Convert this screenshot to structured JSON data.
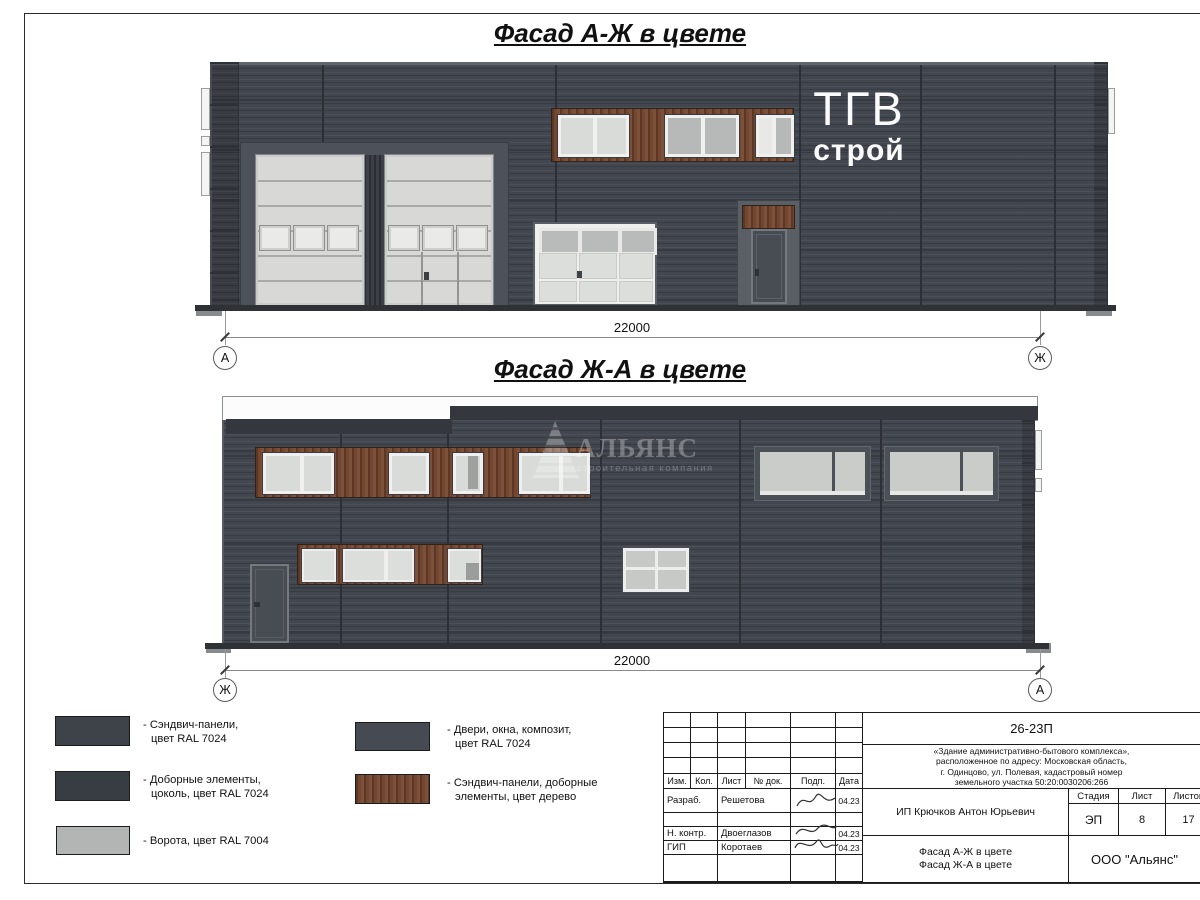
{
  "titles": {
    "facade1": "Фасад А-Ж в цвете",
    "facade2": "Фасад Ж-А в цвете"
  },
  "facade1": {
    "sign_line1": "ТГВ",
    "sign_line2": "строй",
    "dimension": "22000",
    "axis_left": "А",
    "axis_right": "Ж"
  },
  "facade2": {
    "dimension": "22000",
    "axis_left": "Ж",
    "axis_right": "А",
    "watermark_name": "АЛЬЯНС",
    "watermark_tagline": "строительная компания"
  },
  "legend": {
    "items": [
      {
        "line1": "- Сэндвич-панели,",
        "line2": "цвет RAL 7024",
        "color": "#3e434a"
      },
      {
        "line1": "- Доборные элементы,",
        "line2": "цоколь, цвет RAL 7024",
        "color": "#383c43"
      },
      {
        "line1": "- Ворота, цвет RAL 7004",
        "line2": "",
        "color": "#b3b5b4"
      },
      {
        "line1": "- Двери, окна, композит,",
        "line2": "цвет RAL 7024",
        "color": "#464b53"
      },
      {
        "line1": "- Сэндвич-панели, доборные",
        "line2": "элементы, цвет дерево",
        "color": "#74462f"
      }
    ]
  },
  "colors": {
    "walls_ral7024": "#42464e",
    "gates_ral7004": "#d8d8d6",
    "wood_decor": "#74462f"
  },
  "titleblock": {
    "doc_number": "26-23П",
    "description": [
      "«Здание административно-бытового комплекса»,",
      "расположенное по адресу: Московская область,",
      "г. Одинцово, ул. Полевая, кадастровый номер",
      "земельного участка 50:20:0030206:266"
    ],
    "columns": [
      "Изм.",
      "Кол.",
      "Лист",
      "№ док.",
      "Подп.",
      "Дата"
    ],
    "rows": [
      {
        "role": "Разраб.",
        "name": "Решетова",
        "date": "04.23"
      },
      {
        "role": "Н. контр.",
        "name": "Двоеглазов",
        "date": "04.23"
      },
      {
        "role": "ГИП",
        "name": "Коротаев",
        "date": "04.23"
      }
    ],
    "client": "ИП Крючков Антон Юрьевич",
    "stage_label": "Стадия",
    "sheet_label": "Лист",
    "sheets_label": "Листов",
    "stage": "ЭП",
    "sheet_number": "8",
    "sheets_total": "17",
    "subject_line1": "Фасад А-Ж в цвете",
    "subject_line2": "Фасад Ж-А в цвете",
    "company": "ООО \"Альянс\""
  }
}
